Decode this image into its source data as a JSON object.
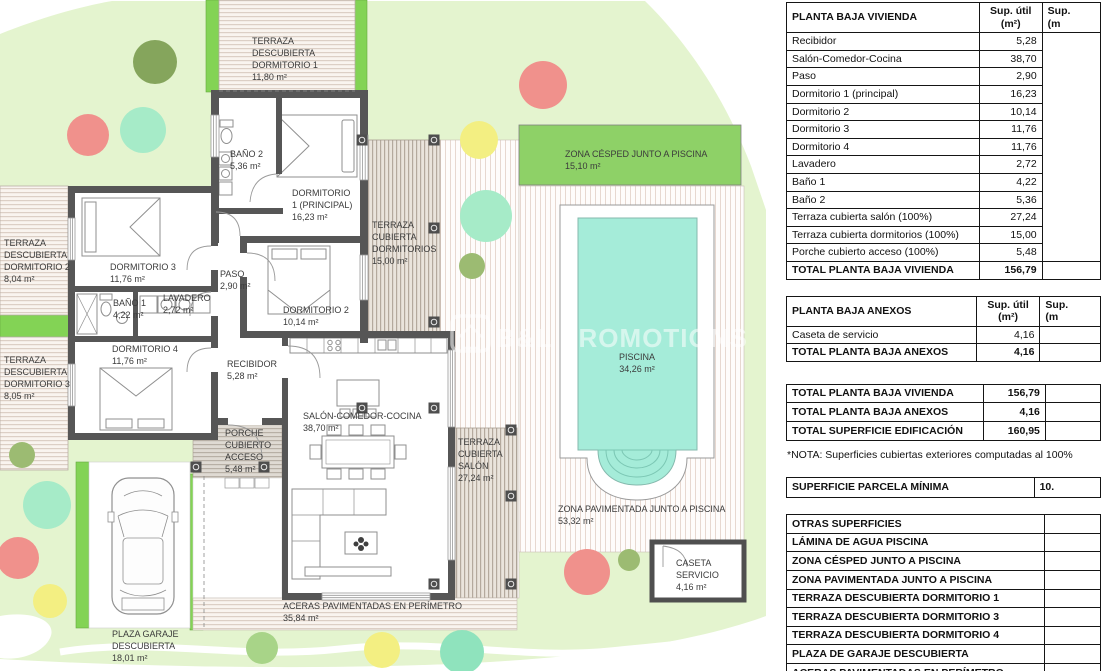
{
  "plan": {
    "watermark": "B&L PROMOTIONS",
    "labels": {
      "terraza_dorm1": [
        "TERRAZA",
        "DESCUBIERTA",
        "DORMITORIO 1",
        "11,80 m²"
      ],
      "bano2": [
        "BAÑO 2",
        "5,36 m²"
      ],
      "dorm1": [
        "DORMITORIO",
        "1 (PRINCIPAL)",
        "16,23 m²"
      ],
      "terraza_cub_dorm": [
        "TERRAZA",
        "CUBIERTA",
        "DORMITORIOS",
        "15,00 m²"
      ],
      "terraza_dorm2": [
        "TERRAZA",
        "DESCUBIERTA",
        "DORMITORIO 2",
        "8,04 m²"
      ],
      "dorm3": [
        "DORMITORIO 3",
        "11,76 m²"
      ],
      "paso": [
        "PASO",
        "2,90 m²"
      ],
      "dorm2": [
        "DORMITORIO 2",
        "10,14 m²"
      ],
      "bano1": [
        "BAÑO 1",
        "4,22 m²"
      ],
      "lavadero": [
        "LAVADERO",
        "2,72 m²"
      ],
      "terraza_dorm3": [
        "TERRAZA",
        "DESCUBIERTA",
        "DORMITORIO 3",
        "8,05 m²"
      ],
      "dorm4": [
        "DORMITORIO 4",
        "11,76 m²"
      ],
      "recibidor": [
        "RECIBIDOR",
        "5,28 m²"
      ],
      "salon": [
        "SALÓN-COMEDOR-COCINA",
        "38,70 m²"
      ],
      "porche": [
        "PORCHE",
        "CUBIERTO",
        "ACCESO",
        "5,48 m²"
      ],
      "terraza_salon": [
        "TERRAZA",
        "CUBIERTA",
        "SALÓN",
        "27,24 m²"
      ],
      "cesped": [
        "ZONA CÉSPED JUNTO A PISCINA",
        "15,10 m²"
      ],
      "piscina": [
        "PISCINA",
        "34,26 m²"
      ],
      "pavimentada": [
        "ZONA PAVIMENTADA JUNTO A PISCINA",
        "53,32 m²"
      ],
      "caseta": [
        "CASETA",
        "SERVICIO",
        "4,16 m²"
      ],
      "aceras": [
        "ACERAS PAVIMENTADAS EN PERÍMETRO",
        "35,84 m²"
      ],
      "garaje": [
        "PLAZA GARAJE",
        "DESCUBIERTA",
        "18,01 m²"
      ]
    },
    "colors": {
      "garden": "#e4f4cf",
      "grass_strip": "#83d355",
      "cesped_band": "#8ed167",
      "pool_water": "#a5ecd9",
      "wall": "#565656",
      "tree_red": "#f0918c",
      "tree_yellow": "#f3ef82",
      "tree_mint": "#a6ebc8",
      "tree_teal": "#8fe3bd",
      "tree_olive": "#9cbb72",
      "tree_dark": "#85a55c"
    }
  },
  "tables": {
    "vivienda": {
      "title": "PLANTA BAJA VIVIENDA",
      "col1_line1": "Sup. útil",
      "col1_line2": "(m²)",
      "col2_line1": "Sup.",
      "col2_line2": "(m",
      "rows": [
        {
          "label": "Recibidor",
          "value": "5,28",
          "open3": true
        },
        {
          "label": "Salón-Comedor-Cocina",
          "value": "38,70",
          "open3": true
        },
        {
          "label": "Paso",
          "value": "2,90",
          "open3": true
        },
        {
          "label": "Dormitorio 1 (principal)",
          "value": "16,23",
          "open3": true
        },
        {
          "label": "Dormitorio 2",
          "value": "10,14",
          "open3": true
        },
        {
          "label": "Dormitorio 3",
          "value": "11,76",
          "open3": true
        },
        {
          "label": "Dormitorio 4",
          "value": "11,76",
          "open3": true
        },
        {
          "label": "Lavadero",
          "value": "2,72",
          "open3": true
        },
        {
          "label": "Baño 1",
          "value": "4,22",
          "open3": true
        },
        {
          "label": "Baño 2",
          "value": "5,36",
          "open3": true
        },
        {
          "label": "Terraza cubierta salón (100%)",
          "value": "27,24",
          "open3": true
        },
        {
          "label": "Terraza cubierta dormitorios (100%)",
          "value": "15,00",
          "open3": true
        },
        {
          "label": "Porche cubierto acceso (100%)",
          "value": "5,48",
          "open3": true
        },
        {
          "label": "TOTAL PLANTA BAJA VIVIENDA",
          "value": "156,79",
          "bold": true
        }
      ]
    },
    "anexos": {
      "title": "PLANTA BAJA ANEXOS",
      "col1_line1": "Sup. útil",
      "col1_line2": "(m²)",
      "col2_line1": "Sup.",
      "col2_line2": "(m",
      "rows": [
        {
          "label": "Caseta de servicio",
          "value": "4,16",
          "open3": true
        },
        {
          "label": "TOTAL PLANTA BAJA ANEXOS",
          "value": "4,16",
          "bold": true
        }
      ]
    },
    "totales": {
      "rows": [
        {
          "label": "TOTAL PLANTA BAJA VIVIENDA",
          "value": "156,79",
          "bold": true
        },
        {
          "label": "TOTAL PLANTA BAJA ANEXOS",
          "value": "4,16",
          "bold": true
        },
        {
          "label": "TOTAL SUPERFICIE EDIFICACIÓN",
          "value": "160,95",
          "bold": true
        }
      ]
    },
    "nota": "*NOTA: Superficies cubiertas exteriores computadas al 100%",
    "parcela": {
      "label": "SUPERFICIE PARCELA MÍNIMA",
      "value": "10."
    },
    "otras": {
      "rows": [
        {
          "label": "OTRAS SUPERFICIES",
          "value": "",
          "bold": true
        },
        {
          "label": "LÁMINA DE AGUA PISCINA",
          "value": "",
          "bold": true
        },
        {
          "label": "ZONA CÉSPED JUNTO A PISCINA",
          "value": "",
          "bold": true
        },
        {
          "label": "ZONA PAVIMENTADA JUNTO A PISCINA",
          "value": "",
          "bold": true
        },
        {
          "label": "TERRAZA DESCUBIERTA DORMITORIO 1",
          "value": "",
          "bold": true
        },
        {
          "label": "TERRAZA DESCUBIERTA DORMITORIO 3",
          "value": "",
          "bold": true
        },
        {
          "label": "TERRAZA DESCUBIERTA DORMITORIO 4",
          "value": "",
          "bold": true
        },
        {
          "label": "PLAZA DE GARAJE DESCUBIERTA",
          "value": "",
          "bold": true
        },
        {
          "label": "ACERAS PAVIMENTADAS EN PERÍMETRO",
          "value": "",
          "bold": true
        }
      ]
    }
  }
}
